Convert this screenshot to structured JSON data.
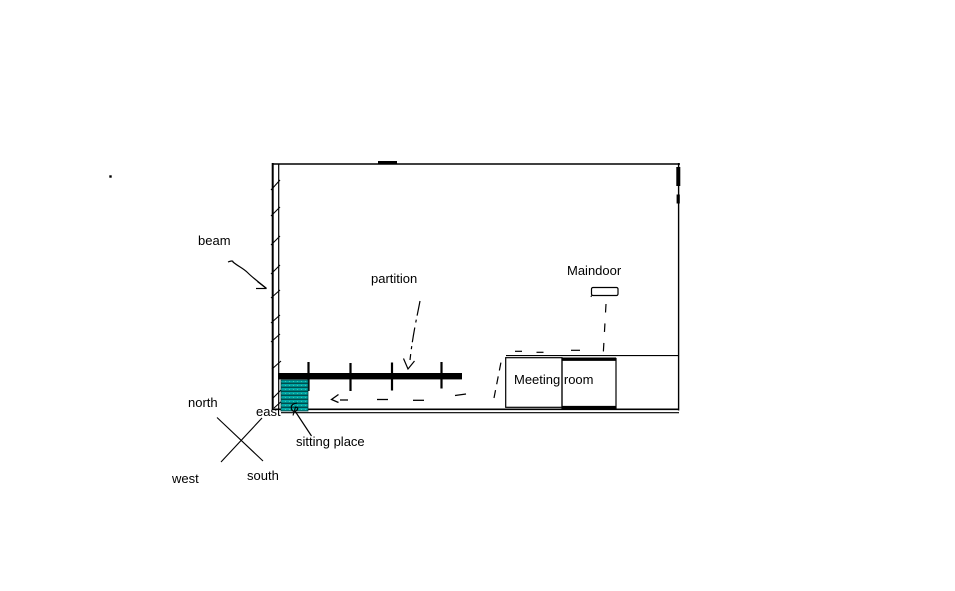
{
  "diagram": {
    "title": "hand-drawn office floor plan sketch",
    "labels": {
      "beam": "beam",
      "partition": "partition",
      "maindoor": "Maindoor",
      "meeting_room": "Meeting room",
      "sitting_place": "sitting place"
    },
    "compass": {
      "north": "north",
      "east": "east",
      "west": "west",
      "south": "south"
    },
    "colors": {
      "line": "#000000",
      "background": "#ffffff",
      "sitting_place_fill": "#00a4a4",
      "sitting_place_stripe": "#014c4c"
    }
  }
}
